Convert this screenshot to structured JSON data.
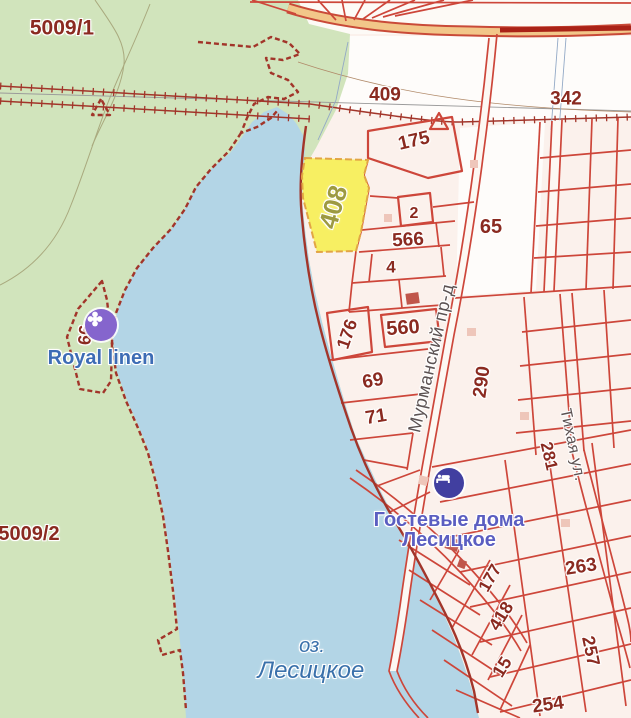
{
  "map_labels": {
    "zones": {
      "z5009_1": "5009/1",
      "z5009_2": "5009/2"
    },
    "lake": {
      "prefix": "оз.",
      "name": "Лесицкое"
    },
    "highlight_parcel": "408",
    "parcels": {
      "p409": "409",
      "p342": "342",
      "p175": "175",
      "p2": "2",
      "p566": "566",
      "p65": "65",
      "p4": "4",
      "p560": "560",
      "p176": "176",
      "p69": "69",
      "p71": "71",
      "p290": "290",
      "p281": "281",
      "p66": "66",
      "p177": "177",
      "p263": "263",
      "p418": "418",
      "p15": "15",
      "p257": "257",
      "p254": "254"
    },
    "streets": {
      "murmansky": "Мурманский пр-д",
      "tihaya": "Тихая ул."
    },
    "pois": {
      "royal_linen": {
        "label": "Royal linen",
        "icon": "flower-icon"
      },
      "guest_houses": {
        "label_line1": "Гостевые дома",
        "label_line2": "Лесицкое",
        "icon": "bed-icon"
      }
    }
  },
  "colors": {
    "base": "#fdfaf6",
    "forest": "#d1e4bc",
    "lake": "#b3d5e6",
    "parcel_fill": "#fbf1ec",
    "parcel_line": "#cd463a",
    "boundary": "#a2352a",
    "cadastral_number": "#8a2a20",
    "highlight_fill": "#f7ef62",
    "highlight_border": "#e2a545",
    "highlight_number": "#9d9a41",
    "road_fill": "#f2c689",
    "road_casing": "#c94a38",
    "street_label": "#5c5252",
    "water_label": "#3a71ab",
    "poi_blue": "#5b5ec1",
    "poi_blue_icon": "#413fa0",
    "poi_purple_label": "#3d6cb5",
    "poi_purple_icon": "#8565cd",
    "contour": "#a9a97e",
    "thin_gray": "#9a9a9a",
    "thin_blue": "#93a9c6"
  }
}
